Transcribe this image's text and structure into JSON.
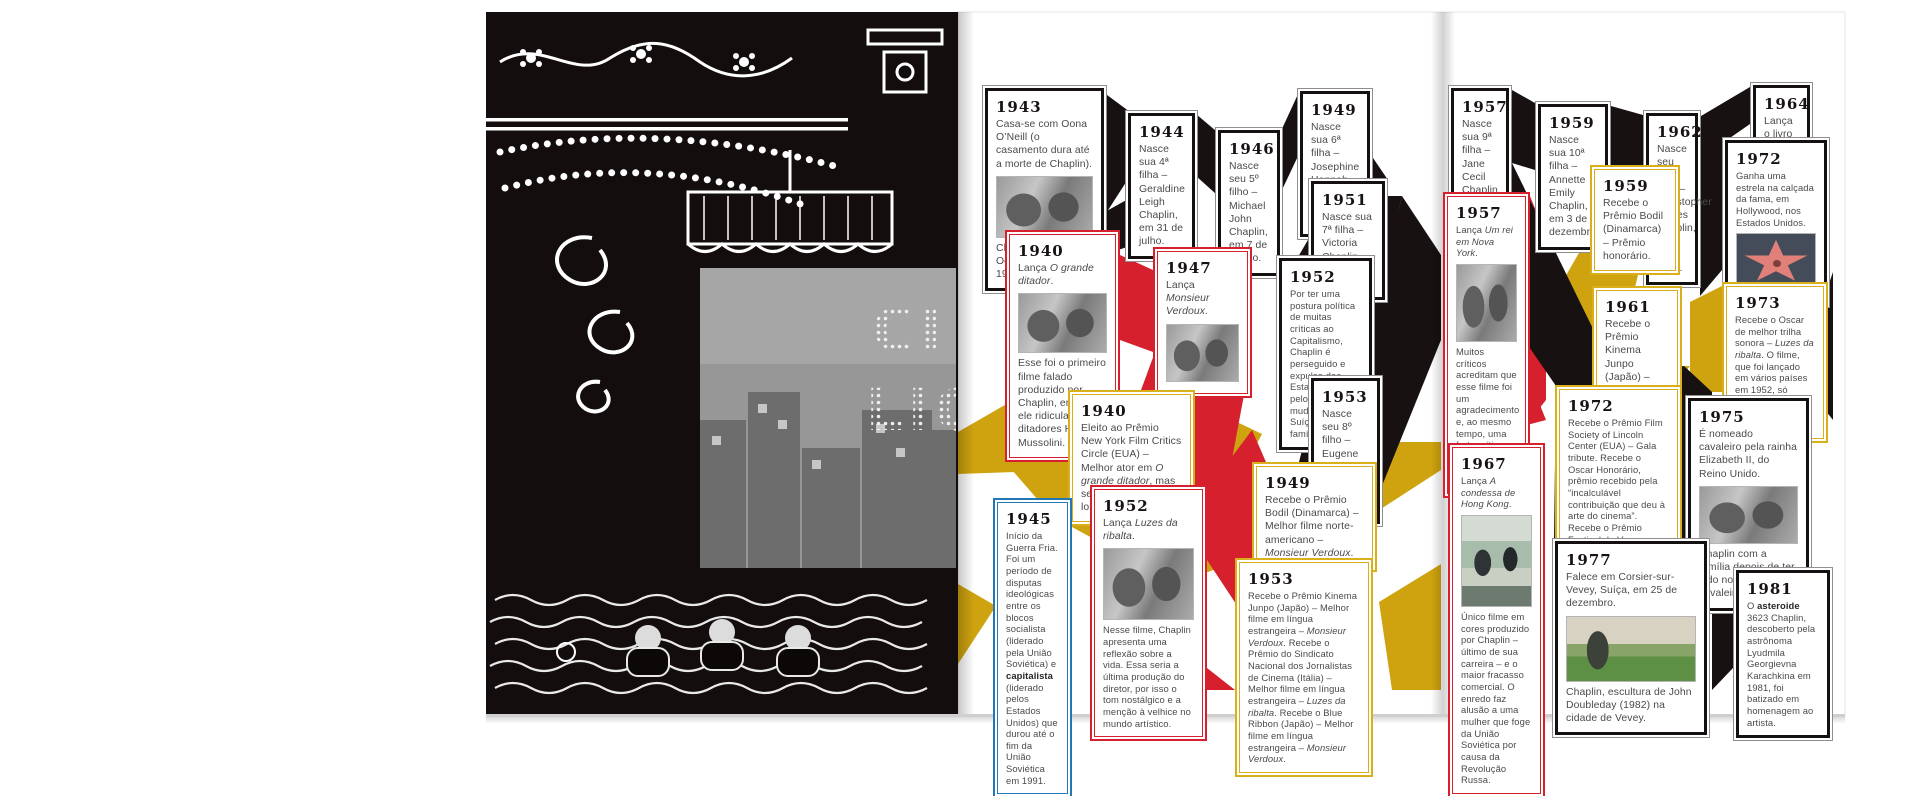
{
  "colors": {
    "red": "#d6202d",
    "yellow": "#cfa30f",
    "blue": "#2277b5",
    "black": "#171111",
    "page": "#ffffff"
  },
  "left_page": {
    "screen_line1": "CI",
    "screen_line2": "LIG"
  },
  "timeline_left": [
    {
      "year": "1943",
      "text_html": "Casa-se com Oona O’Neill (o casamento dura até a morte de Chaplin).",
      "photo": "chaplin-e-oona",
      "caption_html": "Charles Chaplin e Oona O’Neill em 1947."
    },
    {
      "year": "1944",
      "text_html": "Nasce sua 4ª filha – Geraldine Leigh Chaplin, em 31 de julho."
    },
    {
      "year": "1946",
      "text_html": "Nasce seu 5º filho – Michael John Chaplin, em 7 de março."
    },
    {
      "year": "1949",
      "text_html": "Nasce sua 6ª filha – Josephine Hannah Chaplin, em 28 de março."
    },
    {
      "year": "1951",
      "text_html": "Nasce sua 7ª filha – Victoria Chaplin, em 19 de maio."
    },
    {
      "year": "1940",
      "text_html": "Lança <i>O grande ditador</i>.",
      "photo": "cena-o-grande-ditador",
      "caption_html": "Esse foi o primeiro filme falado produzido por Chaplin, em que ele ridiculariza os ditadores Hitler e Mussolini."
    },
    {
      "year": "1947",
      "text_html": "Lança <i>Monsieur Verdoux</i>.",
      "photo": "cena-monsieur-verdoux"
    },
    {
      "year": "1952",
      "text_html": "Por ter uma postura política de muitas críticas ao Capitalismo, Chaplin é perseguido e expulso dos Estados Unidos pelo governo e muda-se para a Suíça com a família."
    },
    {
      "year": "1940",
      "text_html": "Eleito ao Prêmio New York Film Critics Circle (EUA) – Melhor ator em <i>O grande ditador</i>, mas se recusou a recebê-lo."
    },
    {
      "year": "1953",
      "text_html": "Nasce seu 8º filho – Eugene Anthony Chaplin, em 23 de agosto."
    },
    {
      "year": "1945",
      "text_html": "Início da Guerra Fria. Foi um período de disputas ideológicas entre os blocos socialista (liderado pela União Soviética) e <b>capitalista</b> (liderado pelos Estados Unidos) que durou até o fim da União Soviética em 1991."
    },
    {
      "year": "1952",
      "text_html": "Lança <i>Luzes da ribalta</i>.",
      "photo": "cena-luzes-da-ribalta",
      "caption_html": "Nesse filme, Chaplin apresenta uma reflexão sobre a vida. Essa seria a última produção do diretor, por isso o tom nostálgico e a menção à velhice no mundo artístico."
    },
    {
      "year": "1949",
      "text_html": "Recebe o Prêmio Bodil (Dinamarca) – Melhor filme norte-americano – <i>Monsieur Verdoux</i>."
    },
    {
      "year": "1953",
      "text_html": "Recebe o Prêmio Kinema Junpo (Japão) – Melhor filme em língua estrangeira – <i>Monsieur Verdoux</i>. Recebe o Prêmio do Sindicato Nacional dos Jornalistas de Cinema (Itália) – Melhor filme em língua estrangeira – <i>Luzes da ribalta</i>. Recebe o Blue Ribbon (Japão) – Melhor filme em língua estrangeira – <i>Monsieur Verdoux</i>."
    }
  ],
  "timeline_right": [
    {
      "year": "1957",
      "text_html": "Nasce sua 9ª filha – Jane Cecil Chaplin, em 23 de maio."
    },
    {
      "year": "1959",
      "text_html": "Nasce sua 10ª filha – Annette Emily Chaplin, em 3 de dezembro."
    },
    {
      "year": "1962",
      "text_html": "Nasce seu 11º filho – Christopher James Chaplin, em 8 de julho."
    },
    {
      "year": "1964",
      "text_html": "Lança o livro <i>Minha vida</i>."
    },
    {
      "year": "1972",
      "text_html": "Ganha uma estrela na calçada da fama, em Hollywood, nos Estados Unidos.",
      "photo": "estrela-calcada-da-fama"
    },
    {
      "year": "1957",
      "text_html": "Lança <i>Um rei em Nova York</i>.",
      "photo": "cena-um-rei-em-nova-york",
      "caption_html": "Muitos críticos acreditam que esse filme foi um agradecimento e, ao mesmo tempo, uma forte crítica feitos aos Estados Unidos."
    },
    {
      "year": "1959",
      "text_html": "Recebe o Prêmio Bodil (Dinamarca) – Prêmio honorário."
    },
    {
      "year": "1961",
      "text_html": "Recebe o Prêmio Kinema Junpo (Japão) – Melhor filme em língua estrangeira – <i>O grande ditador</i>."
    },
    {
      "year": "1972",
      "text_html": "Recebe o Prêmio Film Society of Lincoln Center (EUA) – Gala tribute. Recebe o Oscar Honorário, prêmio recebido pela “incalculável contribuição que deu à arte do cinema”. Recebe o Prêmio Festival de Veneza (Itália) – Leão de Ouro – Prêmio de Honra."
    },
    {
      "year": "1973",
      "text_html": "Recebe o Oscar de melhor trilha sonora – <i>Luzes da ribalta</i>. O filme, que foi lançado em vários países em 1952, só estreou nos Estados Unidos em 1973."
    },
    {
      "year": "1975",
      "text_html": "É nomeado cavaleiro pela rainha Elizabeth II, do Reino Unido.",
      "photo": "chaplin-com-a-familia",
      "caption_html": "Chaplin com a família depois de ter sido nomeado cavaleiro."
    },
    {
      "year": "1967",
      "text_html": "Lança <i>A condessa de Hong Kong</i>.",
      "photo": "cena-a-condessa-de-hong-kong",
      "caption_html": "Único filme em cores produzido por Chaplin – último de sua carreira – e o maior fracasso comercial. O enredo faz alusão a uma mulher que foge da União Soviética por causa da Revolução Russa."
    },
    {
      "year": "1977",
      "text_html": "Falece em Corsier-sur-Vevey, Suíça, em 25 de dezembro.",
      "photo": "estatua-de-chaplin-em-vevey",
      "caption_html": "Chaplin, escultura de John Doubleday (1982) na cidade de Vevey."
    },
    {
      "year": "1981",
      "text_html": "O <b>asteroide</b> 3623 Chaplin, descoberto pela astrônoma Lyudmila Georgievna Karachkina em 1981, foi batizado em homenagem ao artista."
    }
  ]
}
